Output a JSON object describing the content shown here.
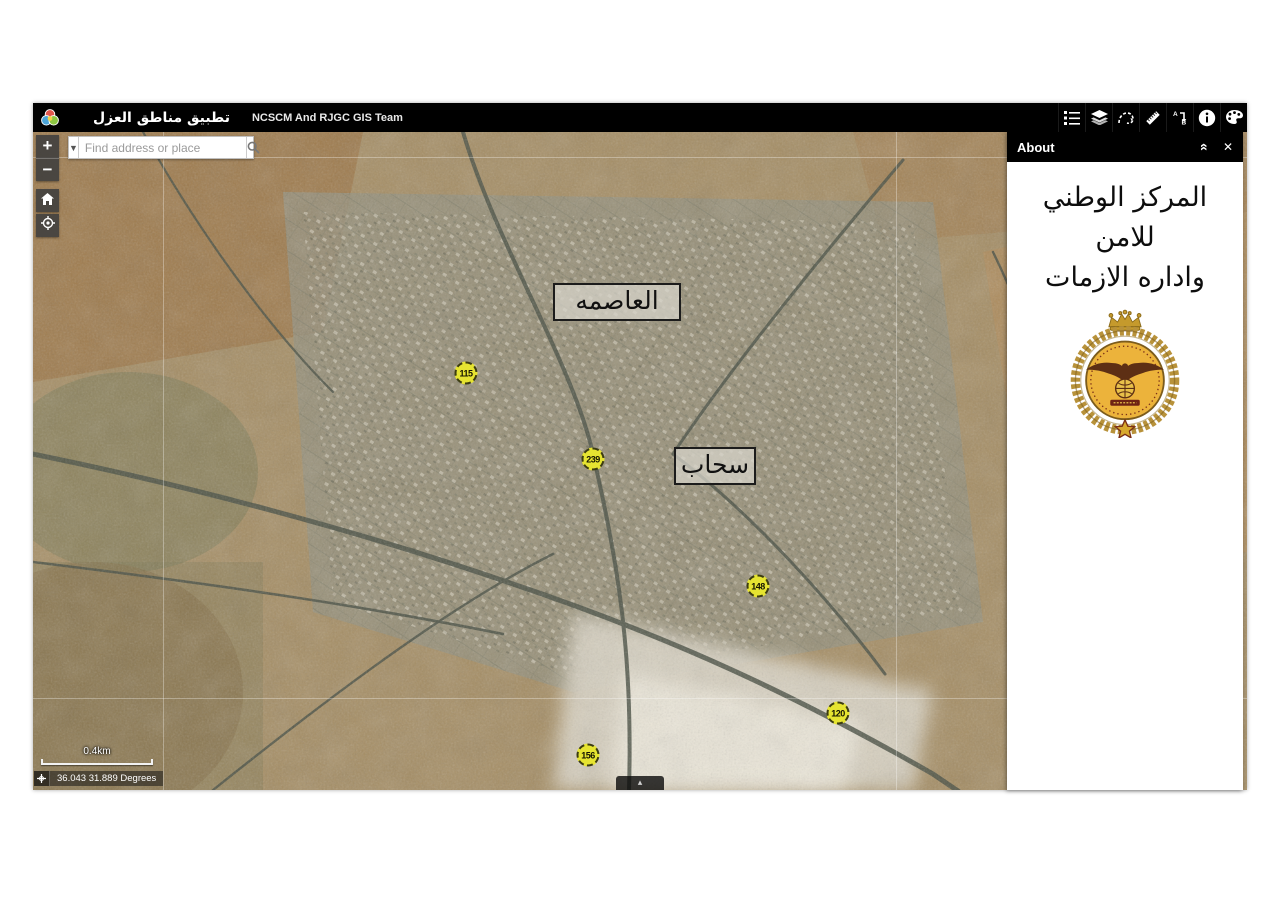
{
  "app": {
    "title": "تطبيق مناطق العزل",
    "subtitle": "NCSCM And RJGC GIS Team"
  },
  "toolbar_icons": [
    "legend-icon",
    "layers-icon",
    "draw-icon",
    "measure-icon",
    "directions-icon",
    "info-icon",
    "basemap-gallery-icon"
  ],
  "search": {
    "placeholder": "Find address or place"
  },
  "map_controls": {
    "zoom_in": "+",
    "zoom_out": "−"
  },
  "map": {
    "labels": [
      {
        "text": "العاصمه"
      },
      {
        "text": "سحاب"
      }
    ],
    "road_shields": [
      {
        "number": "115"
      },
      {
        "number": "239"
      },
      {
        "number": "148"
      },
      {
        "number": "120"
      },
      {
        "number": "156"
      }
    ],
    "scale_label": "0.4km",
    "coordinates": "36.043 31.889 Degrees"
  },
  "about_panel": {
    "title": "About",
    "lines": [
      "المركز الوطني",
      "للامن",
      "واداره الازمات"
    ],
    "emblem": "ncscm-jordan-emblem"
  },
  "colors": {
    "header_bg": "#000000",
    "shield_fill": "#e6e431",
    "emblem_gold": "#ecb33b",
    "map_base": "#a58d63"
  }
}
